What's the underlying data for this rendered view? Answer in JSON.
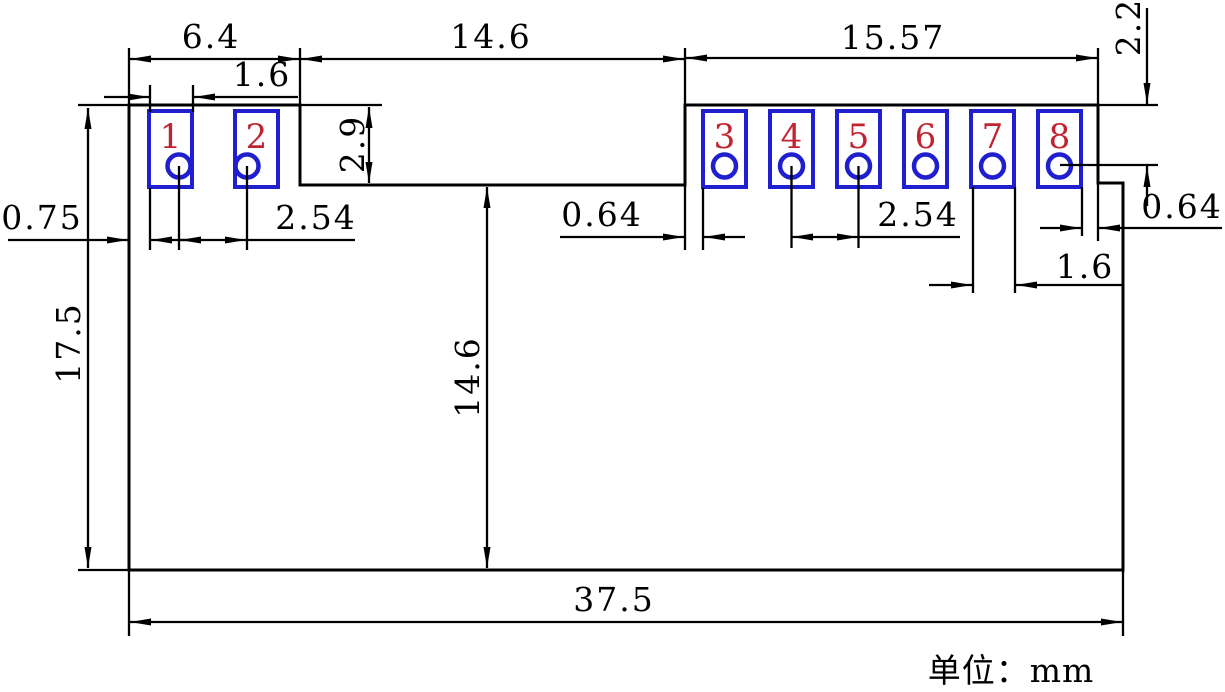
{
  "unit_label": "单位：mm",
  "pad_numbers": [
    "1",
    "2",
    "3",
    "4",
    "5",
    "6",
    "7",
    "8"
  ],
  "dimensions": {
    "left_tab_width": "6.4",
    "pad1_width": "1.6",
    "notch_width": "14.6",
    "right_tab_width": "15.57",
    "top_to_hole": "2.2",
    "notch_depth": "2.9",
    "edge_to_pad1": "0.75",
    "left_hole_pitch": "2.54",
    "body_height": "17.5",
    "notch_to_bottom": "14.6",
    "notch_to_pad3": "0.64",
    "right_hole_pitch": "2.54",
    "pad7_width": "1.6",
    "pad8_to_edge": "0.64",
    "body_width": "37.5"
  },
  "colors": {
    "pad_outline": "#1f1fd0",
    "pad_number": "#c22331",
    "drawing_line": "#000000",
    "background": "#ffffff"
  }
}
